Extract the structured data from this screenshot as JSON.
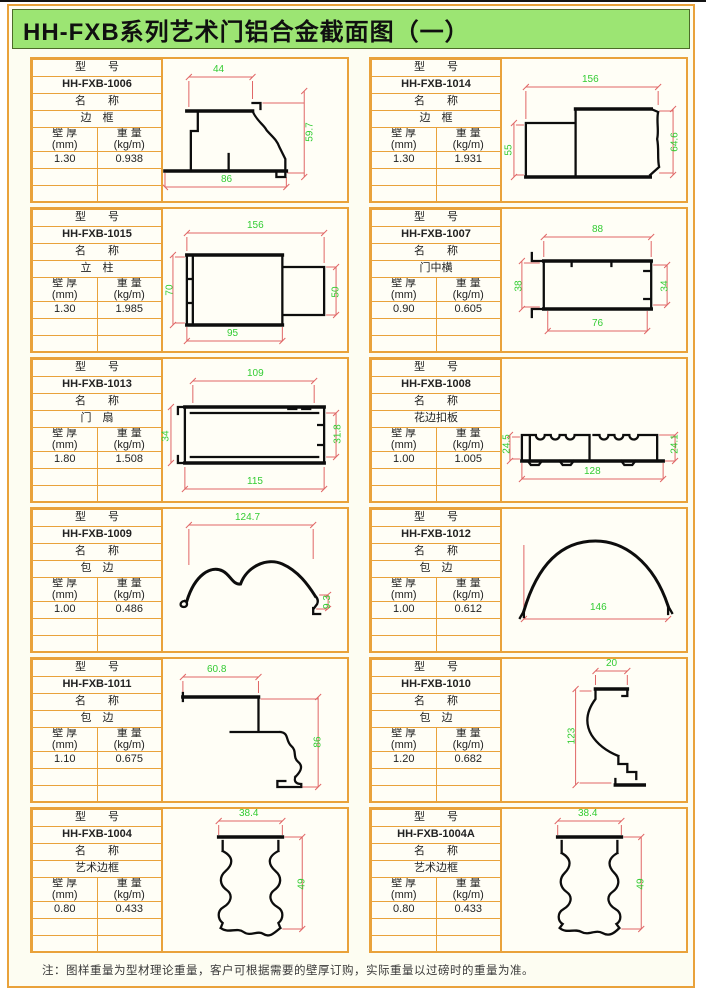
{
  "title": "HH-FXB系列艺术门铝合金截面图（一）",
  "note": "注：图样重量为型材理论重量，客户可根据需要的壁厚订购，实际重量以过磅时的重量为准。",
  "labels": {
    "model_header": "型　　号",
    "name_header": "名　　称",
    "thickness": "壁 厚",
    "thickness_unit": "(mm)",
    "weight": "重 量",
    "weight_unit": "(kg/m)"
  },
  "colors": {
    "border_orange": "#e9a23b",
    "title_green": "#9ce573",
    "dimension_line_red": "#e06666",
    "dimension_text_green": "#33cc33",
    "profile_black": "#0d0d0d"
  },
  "cells": [
    {
      "model": "HH-FXB-1006",
      "name": "边　框",
      "thickness": "1.30",
      "weight": "0.938",
      "dims": {
        "top": "44",
        "right": "59.7",
        "bottom": "86"
      }
    },
    {
      "model": "HH-FXB-1014",
      "name": "边　框",
      "thickness": "1.30",
      "weight": "1.931",
      "dims": {
        "top": "156",
        "left": "55",
        "right": "64.6"
      }
    },
    {
      "model": "HH-FXB-1015",
      "name": "立　柱",
      "thickness": "1.30",
      "weight": "1.985",
      "dims": {
        "top": "156",
        "left": "70",
        "right": "50",
        "bottom": "95"
      }
    },
    {
      "model": "HH-FXB-1007",
      "name": "门中横",
      "thickness": "0.90",
      "weight": "0.605",
      "dims": {
        "top": "88",
        "left": "38",
        "right": "34",
        "bottom": "76"
      }
    },
    {
      "model": "HH-FXB-1013",
      "name": "门　扇",
      "thickness": "1.80",
      "weight": "1.508",
      "dims": {
        "top": "109",
        "left": "34",
        "right": "31.8",
        "bottom": "115"
      }
    },
    {
      "model": "HH-FXB-1008",
      "name": "花边扣板",
      "thickness": "1.00",
      "weight": "1.005",
      "dims": {
        "left": "24.5",
        "right": "24.1",
        "bottom": "128"
      }
    },
    {
      "model": "HH-FXB-1009",
      "name": "包　边",
      "thickness": "1.00",
      "weight": "0.486",
      "dims": {
        "top": "124.7",
        "right": "9.3"
      }
    },
    {
      "model": "HH-FXB-1012",
      "name": "包　边",
      "thickness": "1.00",
      "weight": "0.612",
      "dims": {
        "bottom": "146"
      }
    },
    {
      "model": "HH-FXB-1011",
      "name": "包　边",
      "thickness": "1.10",
      "weight": "0.675",
      "dims": {
        "top": "60.8",
        "right": "86"
      }
    },
    {
      "model": "HH-FXB-1010",
      "name": "包　边",
      "thickness": "1.20",
      "weight": "0.682",
      "dims": {
        "top": "20",
        "left": "123"
      }
    },
    {
      "model": "HH-FXB-1004",
      "name": "艺术边框",
      "thickness": "0.80",
      "weight": "0.433",
      "dims": {
        "top": "38.4",
        "right": "49"
      }
    },
    {
      "model": "HH-FXB-1004A",
      "name": "艺术边框",
      "thickness": "0.80",
      "weight": "0.433",
      "dims": {
        "top": "38.4",
        "right": "49"
      }
    }
  ]
}
